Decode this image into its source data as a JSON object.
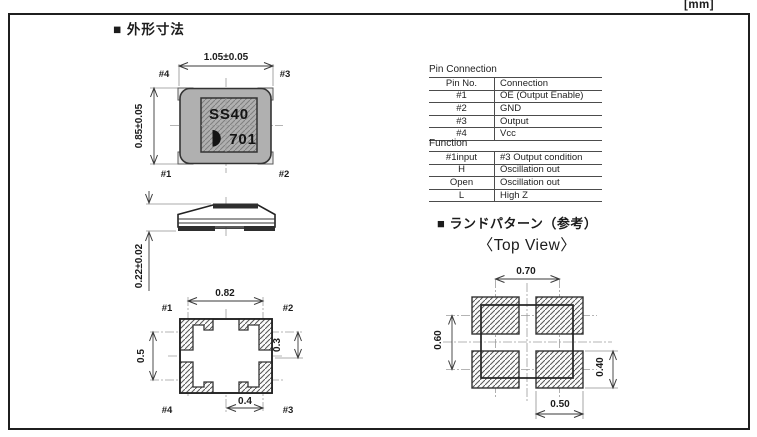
{
  "units_label": "[mm]",
  "headings": {
    "outline": "■ 外形寸法",
    "land_pattern": "■ ランドパターン（参考）",
    "land_pattern_sub": "〈Top View〉"
  },
  "top_view": {
    "dim_width": "1.05±0.05",
    "dim_height": "0.85±0.05",
    "marking_line1": "SS40",
    "marking_line2": "701",
    "logo_icon": "half-moon-logo",
    "pin_top_left": "#4",
    "pin_top_right": "#3",
    "pin_bottom_left": "#1",
    "pin_bottom_right": "#2"
  },
  "side_view": {
    "dim_height": "0.22±0.02"
  },
  "bottom_view": {
    "dim_width": "0.82",
    "dim_left": "0.5",
    "dim_right": "0.3",
    "dim_bottom": "0.4",
    "pin_top_left": "#1",
    "pin_top_right": "#2",
    "pin_bottom_left": "#4",
    "pin_bottom_right": "#3"
  },
  "land_pattern": {
    "dim_top": "0.70",
    "dim_left": "0.60",
    "dim_right": "0.40",
    "dim_bottom": "0.50"
  },
  "pin_connection_table": {
    "title": "Pin Connection",
    "headers": [
      "Pin No.",
      "Connection"
    ],
    "rows": [
      [
        "#1",
        "OE (Output Enable)"
      ],
      [
        "#2",
        "GND"
      ],
      [
        "#3",
        "Output"
      ],
      [
        "#4",
        "Vcc"
      ]
    ]
  },
  "function_table": {
    "title": "Function",
    "headers": [
      "#1input",
      "#3 Output condition"
    ],
    "rows": [
      [
        "H",
        "Oscillation out"
      ],
      [
        "Open",
        "Oscillation out"
      ],
      [
        "L",
        "High Z"
      ]
    ]
  }
}
